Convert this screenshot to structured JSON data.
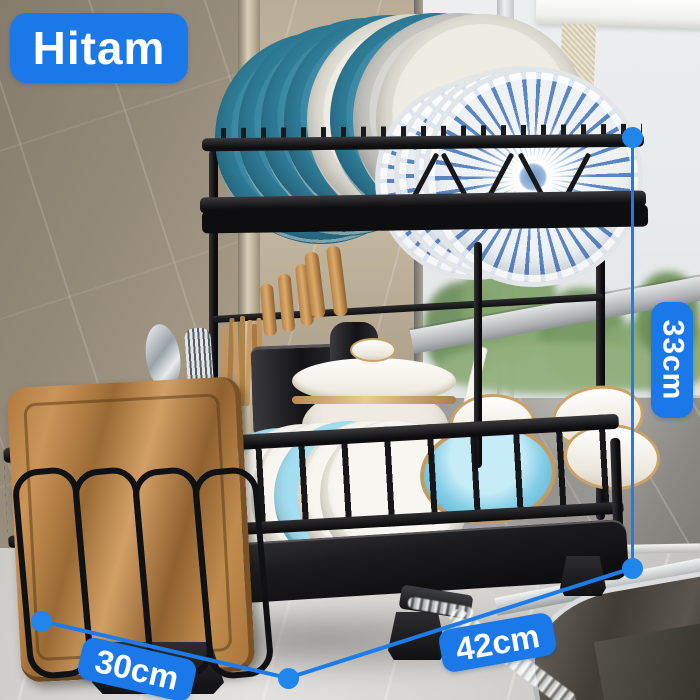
{
  "product_overlay": {
    "color_label": "Hitam",
    "height": "33cm",
    "width": "42cm",
    "depth": "30cm"
  },
  "colors": {
    "accent_blue": "#1A78E9",
    "overlay_text": "#FFFFFF"
  },
  "icons": {
    "dimension_endpoints": "blue-dot-icon"
  }
}
